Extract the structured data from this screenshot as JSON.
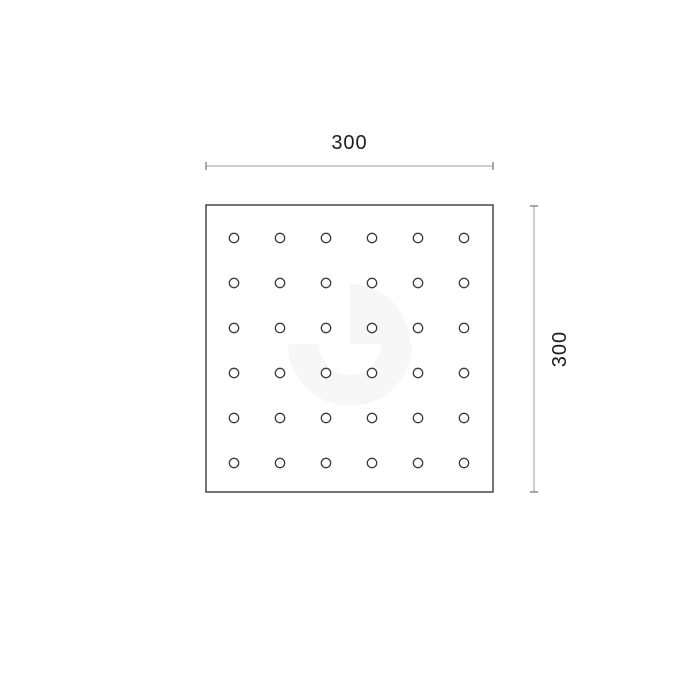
{
  "drawing": {
    "name": "perforated-square-plate",
    "background_color": "#ffffff",
    "plate": {
      "x": 206,
      "y": 205,
      "width": 287,
      "height": 287,
      "stroke_color": "#3a3a3a",
      "stroke_width": 1.4
    },
    "holes": {
      "rows": 6,
      "cols": 6,
      "first_cx": 234,
      "first_cy": 238,
      "pitch_x": 46,
      "pitch_y": 45,
      "radius": 4.7,
      "stroke_color": "#3a3a3a",
      "stroke_width": 1.3
    },
    "dimensions": {
      "line_color": "#9c9c9c",
      "tick_color": "#8a8a8a",
      "text_color": "#1c1c1c",
      "tick_half_length": 4,
      "top": {
        "value": "300",
        "y": 166,
        "x1": 206,
        "x2": 493
      },
      "right": {
        "value": "300",
        "x": 534,
        "y1": 206,
        "y2": 492
      }
    },
    "watermark": {
      "color": "#f7f7f7",
      "cx": 350,
      "cy": 344,
      "wedge_radius": 60,
      "ring_outer_radius": 62,
      "ring_inner_radius": 31
    }
  }
}
